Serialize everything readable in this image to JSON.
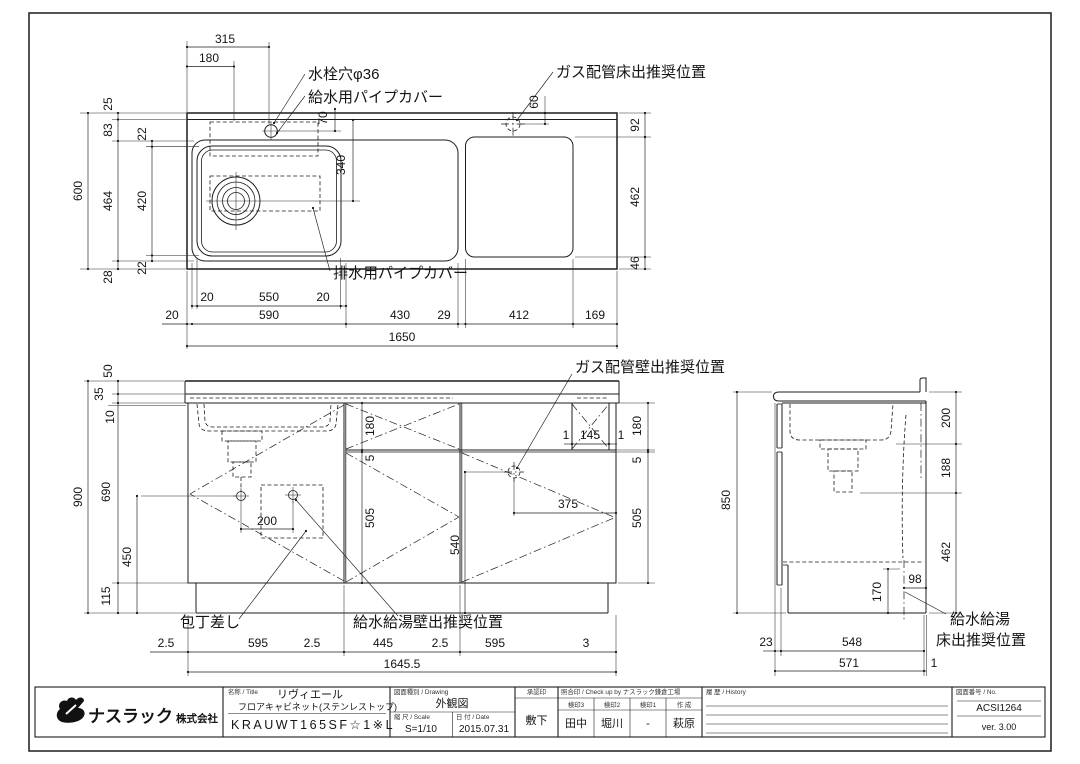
{
  "labels": {
    "faucet_hole": "水栓穴φ36",
    "supply_pipe_cover": "給水用パイプカバー",
    "gas_floor": "ガス配管床出推奨位置",
    "drain_pipe_cover": "排水用パイプカバー",
    "gas_wall": "ガス配管壁出推奨位置",
    "knife_slot": "包丁差し",
    "supply_wall": "給水給湯壁出推奨位置",
    "supply_floor_line1": "給水給湯",
    "supply_floor_line2": "床出推奨位置"
  },
  "plan": {
    "d315": "315",
    "d180": "180",
    "d70": "70",
    "d340": "340",
    "d60": "60",
    "d92": "92",
    "d462": "462",
    "d46": "46",
    "d600": "600",
    "d25": "25",
    "d83": "83",
    "d464": "464",
    "d28": "28",
    "d22a": "22",
    "d420": "420",
    "d22b": "22",
    "b20a": "20",
    "b550": "550",
    "b20b": "20",
    "b20c": "20",
    "b590": "590",
    "b430": "430",
    "b29": "29",
    "b412": "412",
    "b169": "169",
    "b1650": "1650"
  },
  "front": {
    "d50": "50",
    "d35": "35",
    "d10": "10",
    "d900": "900",
    "d690": "690",
    "d450": "450",
    "d115": "115",
    "m180": "180",
    "m5": "5",
    "m505": "505",
    "r180": "180",
    "r5": "5",
    "r505": "505",
    "d200": "200",
    "d540": "540",
    "d375": "375",
    "s1a": "1",
    "s145": "145",
    "s1b": "1",
    "b25a": "2.5",
    "b595a": "595",
    "b25b": "2.5",
    "b445": "445",
    "b25c": "2.5",
    "b595b": "595",
    "b3": "3",
    "btotal": "1645.5"
  },
  "side": {
    "d850": "850",
    "r200": "200",
    "r188": "188",
    "r462": "462",
    "d98": "98",
    "d170": "170",
    "b23": "23",
    "b548": "548",
    "b571": "571",
    "b1": "1"
  },
  "title": {
    "company_main": "ナスラック",
    "company_suffix": "株式会社",
    "name_label": "名称 / Title",
    "series": "リヴィエール",
    "product": "フロアキャビネット(ステンレストップ)",
    "model": "KRAUWT165SF☆1※L",
    "drawing_label": "図面種別 / Drawing",
    "drawing_type": "外観図",
    "scale_label": "縮 尺 / Scale",
    "scale": "S=1/10",
    "date_label": "日 付 / Date",
    "date": "2015.07.31",
    "approval_label": "承認印",
    "approval_name": "敷下",
    "check_label": "照合印 / Check up by ナスラック鎌倉工場",
    "stamp3_label": "検印3",
    "stamp2_label": "検印2",
    "stamp1_label": "検印1",
    "author_label": "作 成",
    "stamp3": "田中",
    "stamp2": "堀川",
    "stamp1": "-",
    "author": "萩原",
    "history_label": "履 歴 / History",
    "no_label": "図面番号 / No.",
    "drawing_no": "ACSI1264",
    "version": "ver. 3.00"
  }
}
